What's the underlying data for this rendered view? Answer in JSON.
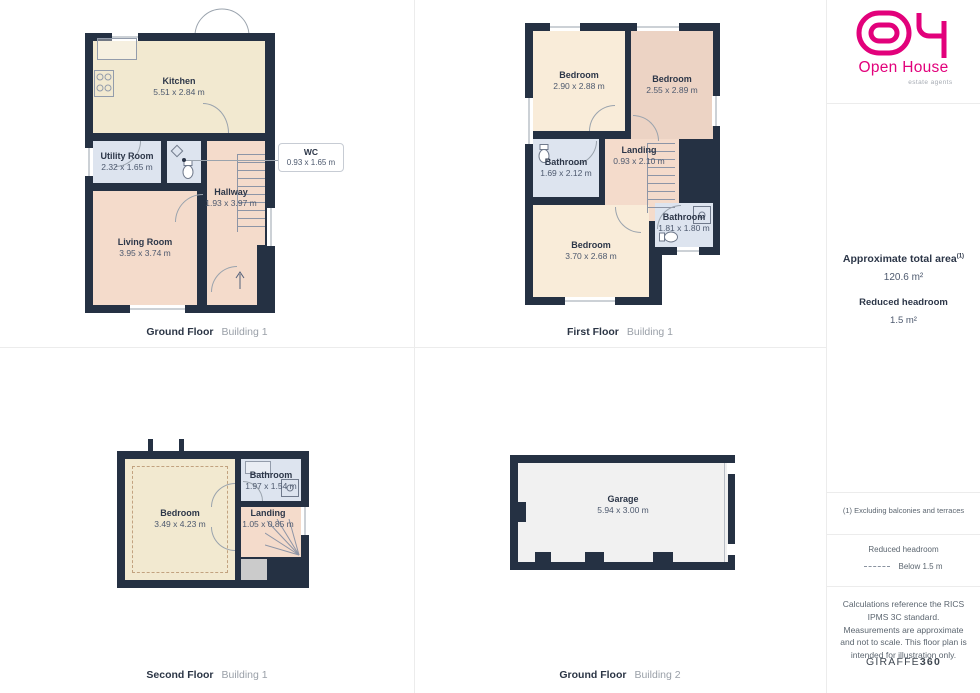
{
  "branding": {
    "brand_name": "Open House",
    "brand_tagline": "estate agents",
    "brand_color": "#e2017b",
    "footer_brand_regular": "GIRAFFE",
    "footer_brand_bold": "360"
  },
  "summary": {
    "area_title": "Approximate total area",
    "area_footnote_marker": "(1)",
    "area_value": "120.6 m²",
    "headroom_title": "Reduced headroom",
    "headroom_value": "1.5 m²"
  },
  "notes": {
    "footnote": "(1) Excluding balconies and terraces",
    "legend_title": "Reduced headroom",
    "legend_label": "Below 1.5 m",
    "disclaimer": "Calculations reference the RICS IPMS 3C standard. Measurements are approximate and not to scale. This floor plan is intended for illustration only."
  },
  "palette": {
    "wall": "#253143",
    "room_cream": "#f2e9d0",
    "room_peach": "#f9ecd9",
    "room_salmon": "#ecd3c4",
    "room_pink": "#f4dbcb",
    "room_blue": "#dde4ef",
    "room_garage": "#f1f1f1"
  },
  "plans": {
    "gf1": {
      "caption": {
        "floor": "Ground Floor",
        "building": "Building 1"
      },
      "rooms": {
        "kitchen": {
          "name": "Kitchen",
          "dims": "5.51 x 2.84 m"
        },
        "utility": {
          "name": "Utility Room",
          "dims": "2.32 x 1.65 m"
        },
        "wc": {
          "name": "WC",
          "dims": "0.93 x 1.65 m"
        },
        "hallway": {
          "name": "Hallway",
          "dims": "1.93 x 3.97 m"
        },
        "living": {
          "name": "Living Room",
          "dims": "3.95 x 3.74 m"
        }
      }
    },
    "ff1": {
      "caption": {
        "floor": "First Floor",
        "building": "Building 1"
      },
      "rooms": {
        "bedroom_a": {
          "name": "Bedroom",
          "dims": "2.90 x 2.88 m"
        },
        "bedroom_b": {
          "name": "Bedroom",
          "dims": "2.55 x 2.89 m"
        },
        "bathroom_a": {
          "name": "Bathroom",
          "dims": "1.69 x 2.12 m"
        },
        "landing": {
          "name": "Landing",
          "dims": "0.93 x 2.10 m"
        },
        "bathroom_b": {
          "name": "Bathroom",
          "dims": "1.81 x 1.80 m"
        },
        "bedroom_c": {
          "name": "Bedroom",
          "dims": "3.70 x 2.68 m"
        }
      }
    },
    "sf1": {
      "caption": {
        "floor": "Second Floor",
        "building": "Building 1"
      },
      "rooms": {
        "bedroom": {
          "name": "Bedroom",
          "dims": "3.49 x 4.23 m"
        },
        "bathroom": {
          "name": "Bathroom",
          "dims": "1.97 x 1.54 m"
        },
        "landing": {
          "name": "Landing",
          "dims": "1.05 x 0.85 m"
        }
      }
    },
    "gf2": {
      "caption": {
        "floor": "Ground Floor",
        "building": "Building 2"
      },
      "rooms": {
        "garage": {
          "name": "Garage",
          "dims": "5.94 x 3.00 m"
        }
      }
    }
  }
}
